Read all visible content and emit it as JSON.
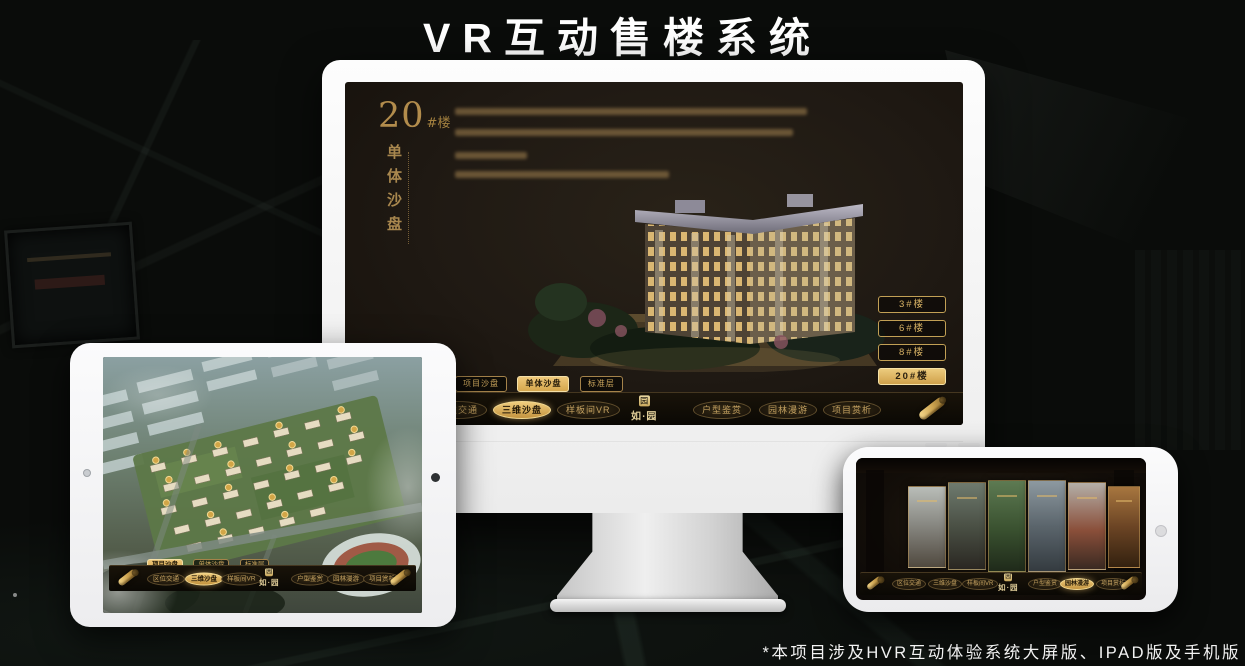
{
  "page": {
    "title": "VR互动售楼系统",
    "footnote": "*本项目涉及HVR互动体验系统大屏版、IPAD版及手机版"
  },
  "colors": {
    "gold": "#c9a159",
    "gold_active": "#e2b765",
    "screen_bg": "#1f1a13",
    "monitor_body": "#f5f5f5"
  },
  "logo": {
    "name": "如·园",
    "seal": "园"
  },
  "desktop_screen": {
    "block_no": "20",
    "block_unit": "#楼",
    "block_caption": "单体沙盘",
    "floor_buttons": [
      {
        "label": "3#楼",
        "active": false
      },
      {
        "label": "6#楼",
        "active": false
      },
      {
        "label": "8#楼",
        "active": false
      },
      {
        "label": "20#楼",
        "active": true
      }
    ],
    "sub_tabs": [
      {
        "label": "项目沙盘",
        "active": false
      },
      {
        "label": "单体沙盘",
        "active": true
      },
      {
        "label": "标准层",
        "active": false
      }
    ],
    "menu": [
      "区位交通",
      "三维沙盘",
      "样板间VR",
      "户型鉴赏",
      "园林漫游",
      "项目赏析"
    ],
    "menu_active": "三维沙盘"
  },
  "tablet_screen": {
    "sub_tabs": [
      {
        "label": "项目沙盘",
        "active": true
      },
      {
        "label": "单体沙盘",
        "active": false
      },
      {
        "label": "标准层",
        "active": false
      }
    ],
    "menu": [
      "区位交通",
      "三维沙盘",
      "样板间VR",
      "户型鉴赏",
      "园林漫游",
      "项目赏析"
    ],
    "menu_active": "三维沙盘"
  },
  "phone_screen": {
    "menu": [
      "区位交通",
      "三维沙盘",
      "样板间VR",
      "户型鉴赏",
      "园林漫游",
      "项目赏析"
    ],
    "menu_active": "园林漫游"
  }
}
